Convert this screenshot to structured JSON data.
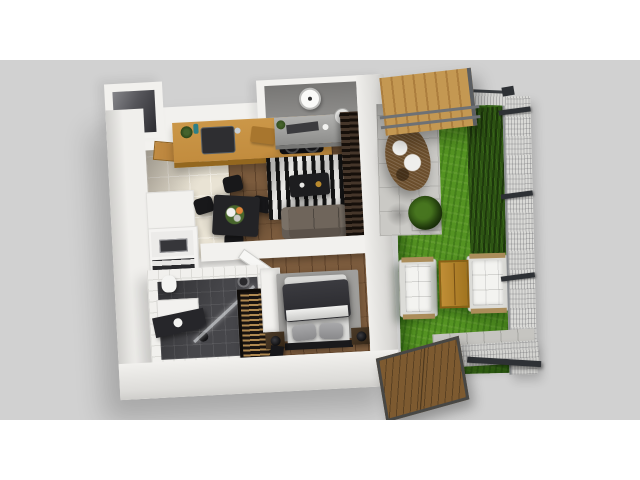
{
  "meta": {
    "description": "3D top-down render of a small apartment floor plan with attached garden terrace on a gray studio background",
    "text_visible": false
  },
  "palette": {
    "bg-page": "#ffffff",
    "bg-canvas": "#d1d1d1",
    "wall": "#f2f1ee",
    "tile-floor": "#e9e3d4",
    "tile-line": "#f7f3e9",
    "wood-floor": "#7b5b3d",
    "counter-wood": "#c28c3e",
    "counter-edge": "#93671f",
    "cooktop-black": "#121214",
    "sink-dark": "#2e2e31",
    "accent-wall-gray": "#8d8c8a",
    "rug-stripe-dark": "#161616",
    "rug-stripe-light": "#edece9",
    "sofa-gray": "#6f655b",
    "chair-black": "#18181a",
    "bath-floor": "#46464a",
    "bath-tile": "#f1f0ed",
    "bed-duvet": "#28282c",
    "bedroom-rug": "#9c9b98",
    "grass-green": "#549322",
    "hedge-green": "#2d5413",
    "patio-gray": "#cac9c5",
    "pergola-wood": "#c49852",
    "wicker-brown": "#6b4e2c",
    "outdoor-cushion": "#f3f3f0",
    "outdoor-table-wood": "#c08e36",
    "deck-wood": "#7d5a30",
    "fence-mesh": "#dadad7",
    "fence-post": "#2e3135",
    "glass": "rgba(240,243,246,0.6)"
  },
  "scene": {
    "view": "top-down-3d-floorplan",
    "apartment": {
      "kitchen_dining": [
        "wood-countertop",
        "sink",
        "gas-cooktop",
        "cutting-board",
        "herb-plant",
        "upper-cabinet",
        "oven-column",
        "drawer-stack",
        "dining-table",
        "four-black-chairs",
        "flower-centerpiece",
        "beige-tile-floor"
      ],
      "living_room": [
        "gray-accent-wall",
        "wall-clock",
        "gray-console-table",
        "black-white-striped-rug",
        "dark-coffee-table",
        "gray-sofa",
        "dark-slatted-panel",
        "wood-plank-floor"
      ],
      "hallway": [
        "interior-wall",
        "open-white-door",
        "entrance-door",
        "entrance-niche"
      ],
      "bathroom": [
        "white-tile-walls",
        "dark-tile-floor",
        "toilet",
        "vanity-with-dark-counter",
        "glass-shower-screen",
        "shower-head",
        "wood-accent-wall",
        "towel-heater",
        "waste-bin"
      ],
      "bedroom": [
        "white-wardrobe",
        "gray-rug",
        "double-bed-dark-duvet",
        "white-sheet-fold",
        "two-gray-pillows",
        "headboard",
        "two-nightstands",
        "black-table-lamps",
        "floor-speaker",
        "storage-rack"
      ]
    },
    "garden": [
      "grass-lawn",
      "hedge-row",
      "concrete-paver-patio",
      "wood-pergola",
      "hanging-egg-chair",
      "potted-plant",
      "white-outdoor-sofa-left",
      "white-outdoor-sofa-right",
      "wood-coffee-table",
      "mesh-fence-right",
      "mesh-fence-top",
      "mesh-fence-bottom",
      "dark-fence-posts",
      "wood-deck"
    ]
  }
}
